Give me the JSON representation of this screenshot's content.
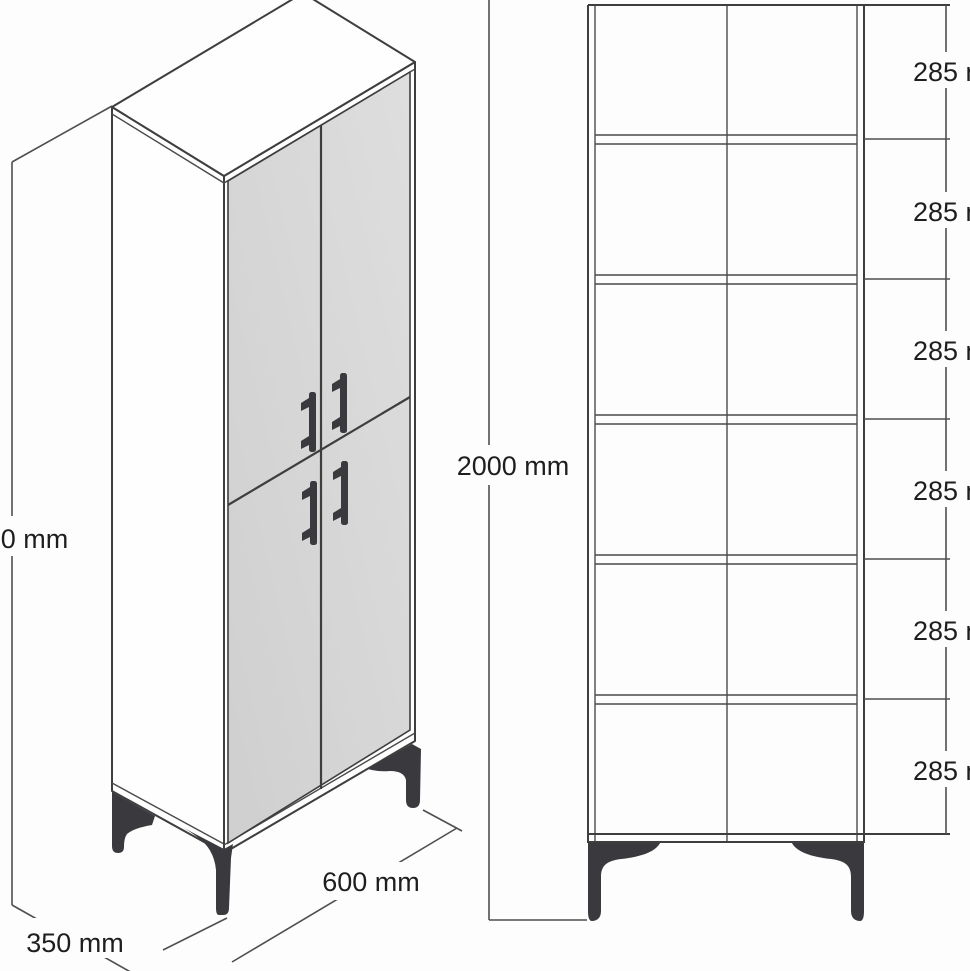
{
  "drawing": {
    "type": "furniture-dimension-diagram",
    "subject": "tall 4-door cabinet with metal feet",
    "units": "mm"
  },
  "views": {
    "isometric": {
      "label": "isometric-view",
      "height_label": "2000 mm",
      "width_label": "600 mm",
      "depth_label": "350 mm",
      "door_count": 4,
      "handle_count": 4,
      "visible_feet": 3
    },
    "front": {
      "label": "front-elevation-view",
      "height_label": "2000 mm",
      "rows": 6,
      "columns": 2,
      "compartments": [
        "285 mm",
        "285 mm",
        "285 mm",
        "285 mm",
        "285 mm",
        "285 mm"
      ],
      "visible_feet": 2
    }
  },
  "colors": {
    "background": "#fdfdfd",
    "line": "#3e3e3e",
    "dimension_line": "#4f4f4f",
    "door_fill_light": "#dcdcdc",
    "door_fill_dark": "#cfcfcf",
    "hardware_dark": "#3a3a3e",
    "text": "#1e1e1e"
  }
}
